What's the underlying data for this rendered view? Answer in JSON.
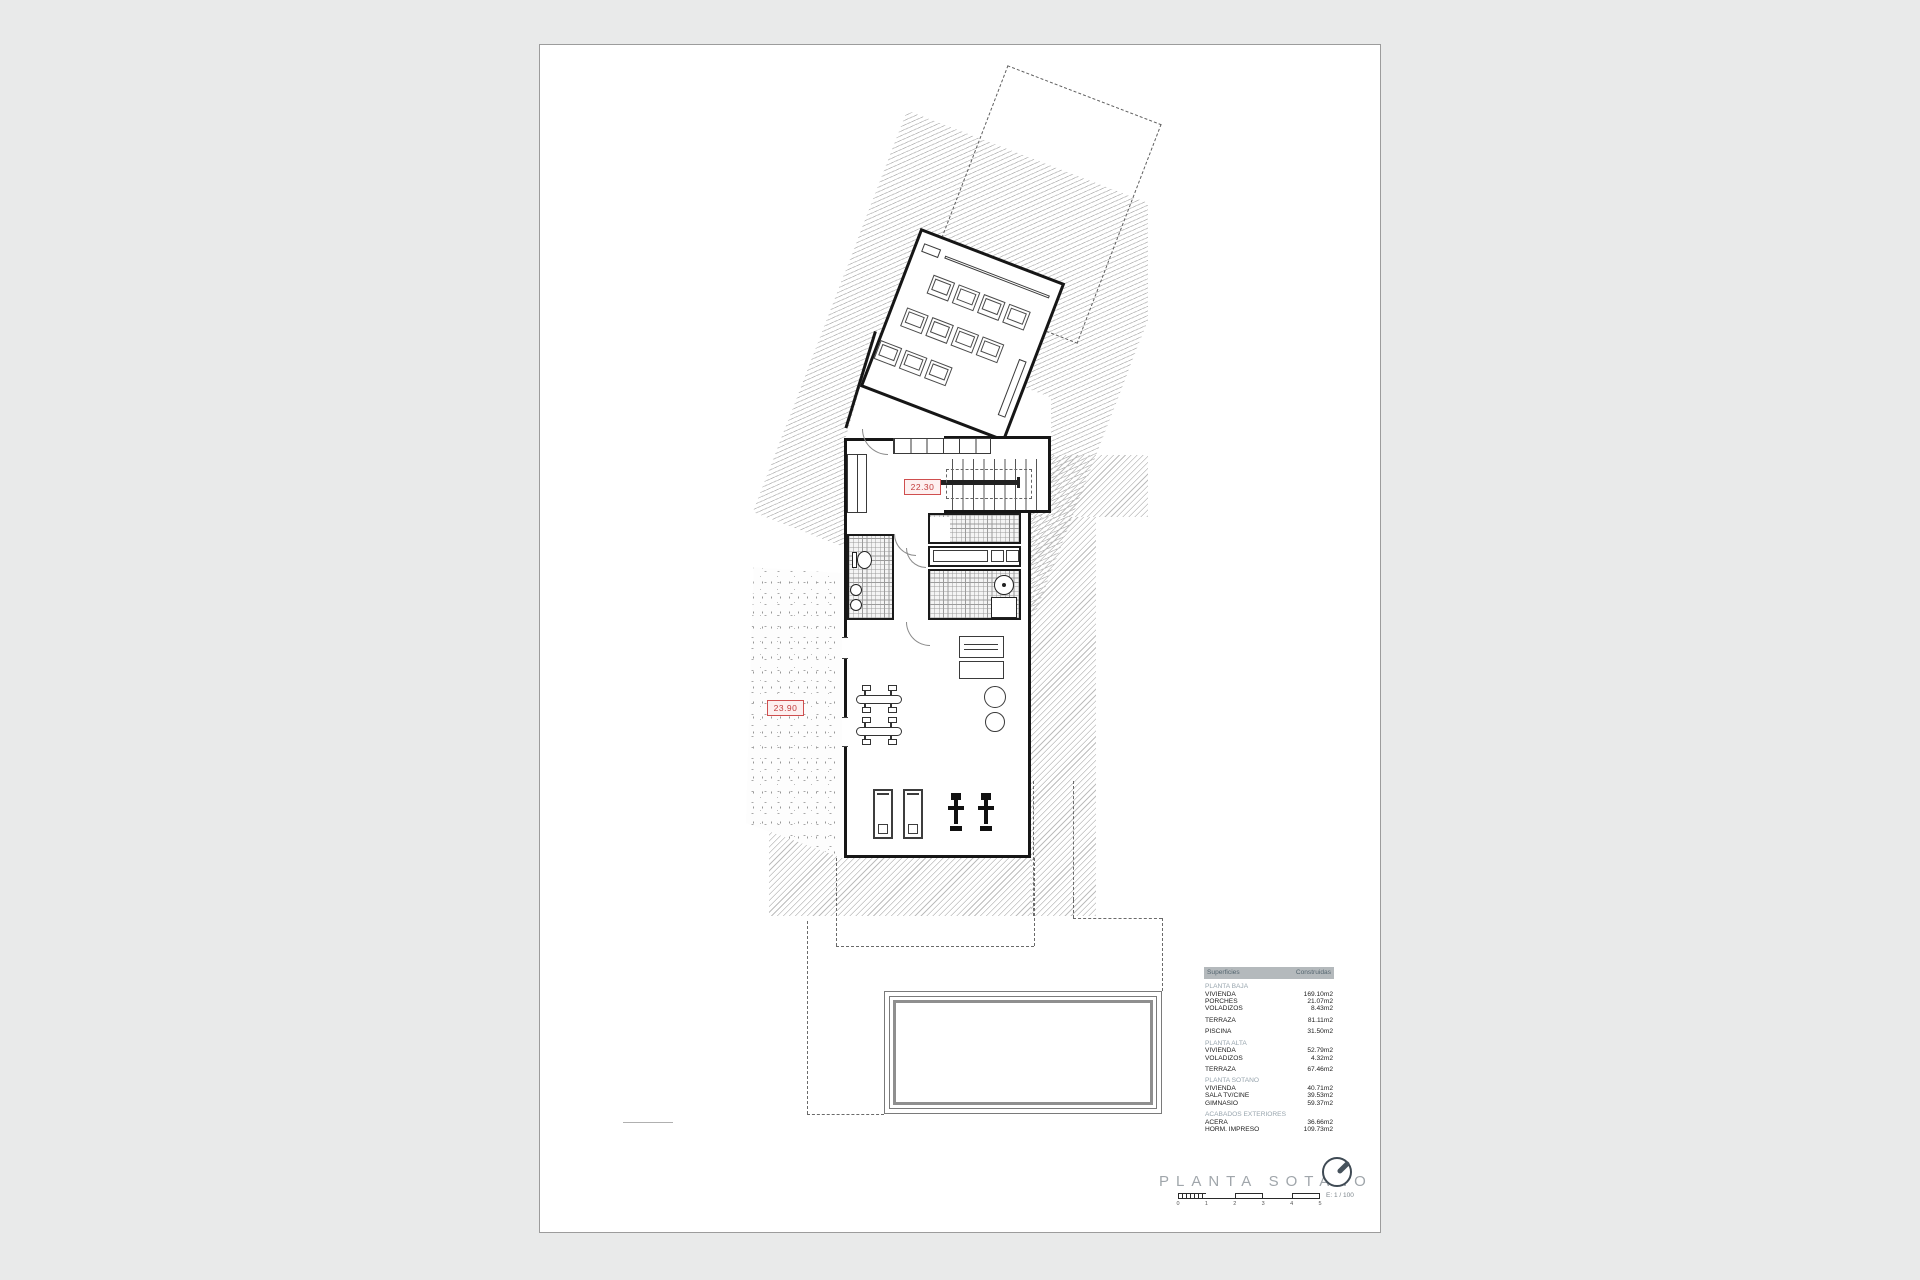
{
  "plan": {
    "name": "basement floor plan",
    "labels": {
      "stair_level": "22.30",
      "terrace_level": "23.90"
    }
  },
  "surfaces": {
    "header": {
      "col1": "Superficies",
      "col2": "Construidas"
    },
    "groups": [
      {
        "header": "PLANTA BAJA",
        "rows": [
          [
            "VIVIENDA",
            "169.10m2"
          ],
          [
            "PORCHES",
            "21.07m2"
          ],
          [
            "VOLADIZOS",
            "8.43m2"
          ]
        ]
      },
      {
        "header": "",
        "rows": [
          [
            "TERRAZA",
            "81.11m2"
          ]
        ]
      },
      {
        "header": "",
        "rows": [
          [
            "PISCINA",
            "31.50m2"
          ]
        ]
      },
      {
        "header": "PLANTA ALTA",
        "rows": [
          [
            "VIVIENDA",
            "52.79m2"
          ],
          [
            "VOLADIZOS",
            "4.32m2"
          ]
        ]
      },
      {
        "header": "",
        "rows": [
          [
            "TERRAZA",
            "67.46m2"
          ]
        ]
      },
      {
        "header": "PLANTA SOTANO",
        "rows": [
          [
            "VIVIENDA",
            "40.71m2"
          ],
          [
            "SALA TV/CINE",
            "39.53m2"
          ],
          [
            "GIMNASIO",
            "59.37m2"
          ]
        ]
      },
      {
        "header": "ACABADOS EXTERIORES",
        "rows": [
          [
            "ACERA",
            "36.66m2"
          ],
          [
            "HORM. IMPRESO",
            "109.73m2"
          ]
        ]
      }
    ]
  },
  "titleblock": {
    "title": "PLANTA SOTANO",
    "scale_note": "E: 1 / 100",
    "scale_ticks": [
      "0",
      "1",
      "2",
      "3",
      "4",
      "5"
    ],
    "north_icon": "north-arrow"
  },
  "colors": {
    "accent_red": "#c23b3b",
    "hatch_line": "#bdbdbd",
    "table_header_bg": "#b4b9bc",
    "section_text": "#98a5ae",
    "title_text": "#a0a6ab"
  }
}
